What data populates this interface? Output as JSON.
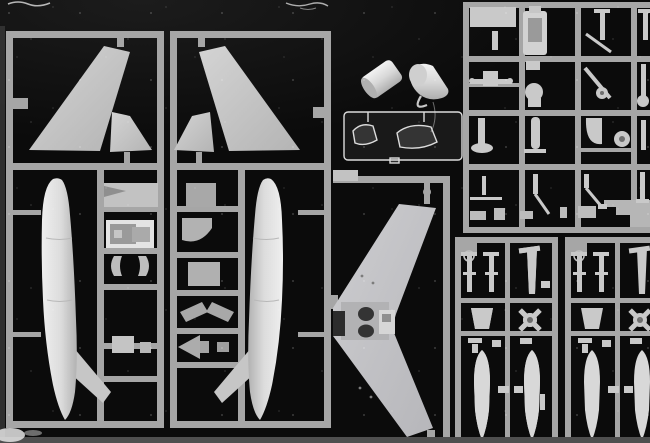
{
  "scene": {
    "type": "scanned-photo",
    "subject": "injection-molded model aircraft kit sprues laid on a black scanner background",
    "monochrome": true
  },
  "colors": {
    "background": "#0b0b0b",
    "edge_strip": "#383838",
    "runner": "#a6a6a6",
    "runner_dim": "#969696",
    "part": "#c9c9c9",
    "part_bright": "#e2e2e2",
    "part_dim": "#a2a2a2",
    "well_dark": "#303030",
    "clear_frame": "#dcdcdc",
    "scan_strip": "#4f4f4f",
    "scratch": "#eeeeee"
  },
  "sprues": [
    {
      "id": "A",
      "name": "port-fuselage-sprue",
      "parts": [
        "vertical-stabilizer",
        "inner-tail-fin",
        "fuselage-half-port",
        "intake-duct",
        "cockpit-tub",
        "intake-lip-left",
        "intake-lip-right",
        "equipment-box"
      ]
    },
    {
      "id": "B",
      "name": "starboard-fuselage-sprue",
      "parts": [
        "vertical-stabilizer-mirror",
        "inner-tail-fin-mirror",
        "fuselage-half-starboard",
        "avionics-box",
        "quarter-bulkhead",
        "avionics-box-2",
        "wedge-fairing-left",
        "wedge-fairing-right",
        "exhaust-cone"
      ]
    },
    {
      "id": "C",
      "name": "wing-sprue",
      "parts": [
        "one-piece-swept-wing",
        "main-wheel-wells",
        "nose-gear-bay"
      ]
    },
    {
      "id": "E",
      "name": "detail-parts-sprue",
      "parts": [
        "blank-plate",
        "ejection-seat",
        "gear-strut-1",
        "gear-strut-2",
        "actuator-cross",
        "exhaust-nozzle",
        "gear-leg-diag",
        "wheel-small",
        "gear-leg-pad",
        "gear-door",
        "main-wheel",
        "antenna-boom",
        "bent-strut",
        "zigzag-strut",
        "step-fairing"
      ]
    },
    {
      "id": "D1",
      "name": "weapons-sprue-1",
      "parts": [
        "missile-1",
        "missile-2",
        "pylon-blade",
        "tail-fairing-trapezoid",
        "fin-wheel-unit",
        "drop-tank-1",
        "drop-tank-2"
      ]
    },
    {
      "id": "D2",
      "name": "weapons-sprue-2",
      "parts": [
        "missile-1",
        "missile-2",
        "pylon-blade",
        "tail-fairing-trapezoid",
        "fin-wheel-unit",
        "drop-tank-1",
        "drop-tank-2"
      ]
    }
  ],
  "loose_parts": [
    "intake-ring-segment",
    "nose-cone"
  ],
  "clear_sprue": {
    "name": "canopy-sprue",
    "parts": [
      "windscreen",
      "canopy"
    ]
  }
}
